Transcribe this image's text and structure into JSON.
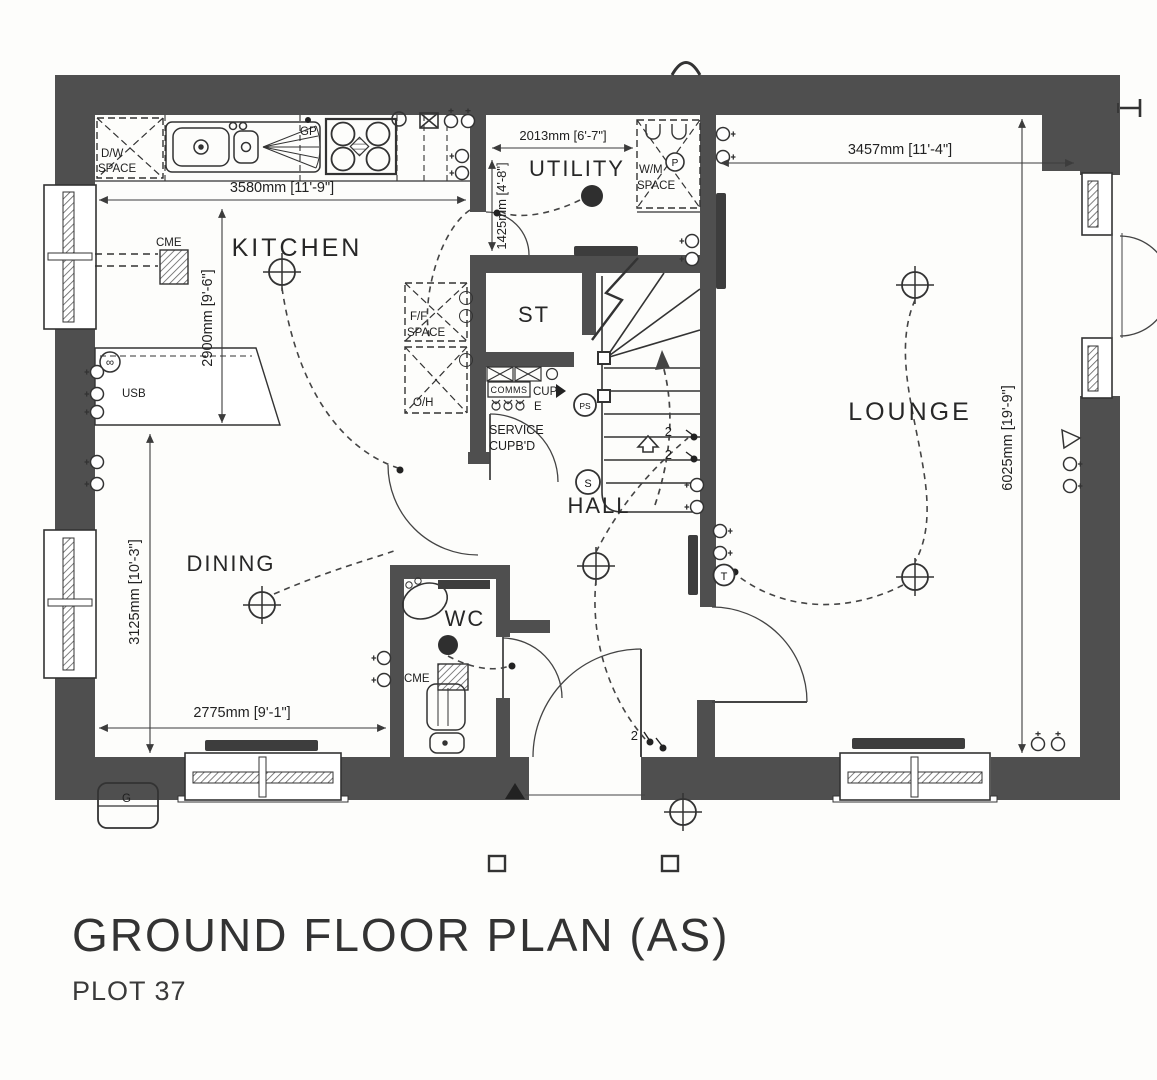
{
  "title": {
    "main": "GROUND FLOOR PLAN (AS)",
    "plot": "PLOT 37"
  },
  "rooms": {
    "kitchen": "KITCHEN",
    "utility": "UTILITY",
    "lounge": "LOUNGE",
    "dining": "DINING",
    "hall": "HALL",
    "wc": "WC",
    "store": "ST"
  },
  "dimensions": {
    "kitchen_width": "3580mm [11'-9\"]",
    "kitchen_depth": "2900mm [9'-6\"]",
    "utility_width": "2013mm [6'-7\"]",
    "utility_depth": "1425mm [4'-8\"]",
    "lounge_width": "3457mm [11'-4\"]",
    "lounge_depth": "6025mm [19'-9\"]",
    "dining_depth": "3125mm [10'-3\"]",
    "dining_width": "2775mm [9'-1\"]"
  },
  "labels": {
    "gp": "GP",
    "usb": "USB",
    "gas_meter": "G",
    "tv_symbol": "∞",
    "cme_kitchen": "CME",
    "cme_wc": "CME",
    "dw1": "D/W",
    "dw2": "SPACE",
    "wm1": "W/M",
    "wm2": "SPACE",
    "ff1": "F/F",
    "ff2": "SPACE",
    "oh": "O/H",
    "comms": "COMMS",
    "cup": "CUP",
    "e": "E",
    "service1": "SERVICE",
    "service2": "CUPB'D",
    "p": "P",
    "ps": "PS",
    "s": "S",
    "t": "T",
    "two_a": "2",
    "two_b": "2",
    "two_c": "2"
  },
  "colors": {
    "wall": "#4f4f4f",
    "line": "#333333",
    "background": "#fdfdfb"
  }
}
